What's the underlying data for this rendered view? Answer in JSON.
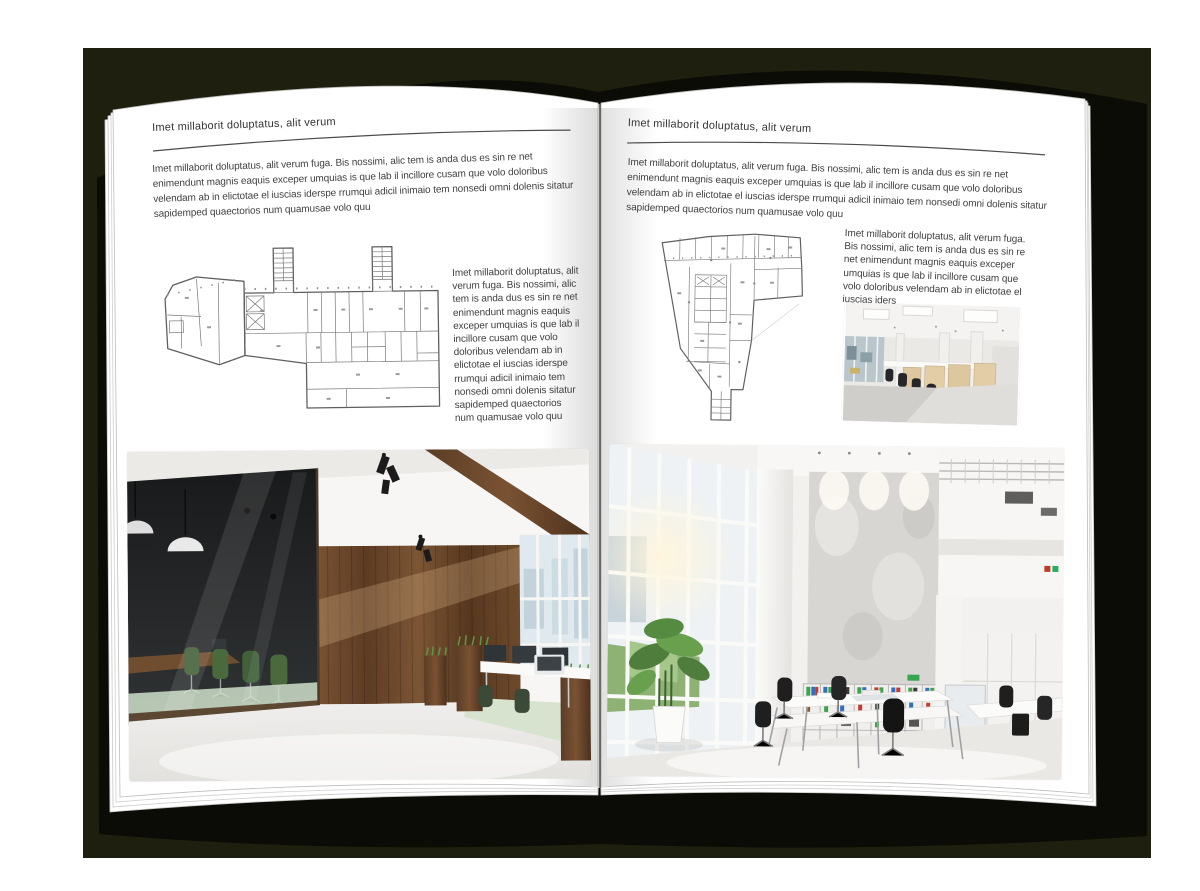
{
  "palette": {
    "backdrop": "#1e1f0e",
    "book_cover": "#0c0c07",
    "page": "#ffffff",
    "body_text": "#414141",
    "header_rule": "#4c4c4c",
    "plan_ink": "#6f6f6f",
    "wood": "#6f4e30",
    "plant_green": "#5f9a44"
  },
  "left_page": {
    "header": "Imet millaborit doluptatus, alit verum",
    "intro": "Imet millaborit doluptatus, alit verum fuga. Bis nossimi, alic tem is anda dus es sin re net enimendunt magnis eaquis exceper umquias is que lab il incillore cusam que volo doloribus velendam ab in elictotae el iuscias iderspe rrumqui adicil inimaio tem nonsedi omni dolenis sitatur sapidemped quaectorios num quamusae volo quu",
    "side_text": "Imet millaborit doluptatus, alit verum fuga. Bis nossimi, alic tem is anda dus es sin re net enimendunt magnis eaquis exceper umquias is que lab il incillore cusam que volo doloribus velendam ab in elictotae el iuscias iderspe rrumqui adicil inimaio tem nonsedi omni dolenis sitatur sapidemped quaectorios num quamusae volo quu"
  },
  "right_page": {
    "header": "Imet millaborit doluptatus, alit verum",
    "intro": "Imet millaborit doluptatus, alit verum fuga. Bis nossimi, alic tem is anda dus es sin re net enimendunt magnis eaquis exceper umquias is que lab il incillore cusam que volo doloribus velendam ab in elictotae el iuscias iderspe rrumqui adicil inimaio tem nonsedi omni dolenis sitatur sapidemped quaectorios num quamusae volo quu",
    "side_text": "Imet millaborit doluptatus, alit verum fuga. Bis nossimi, alic tem is anda dus es sin re net enimendunt magnis eaquis exceper umquias is que lab il incillore cusam que volo doloribus velendam ab in elictotae el iuscias iders"
  }
}
